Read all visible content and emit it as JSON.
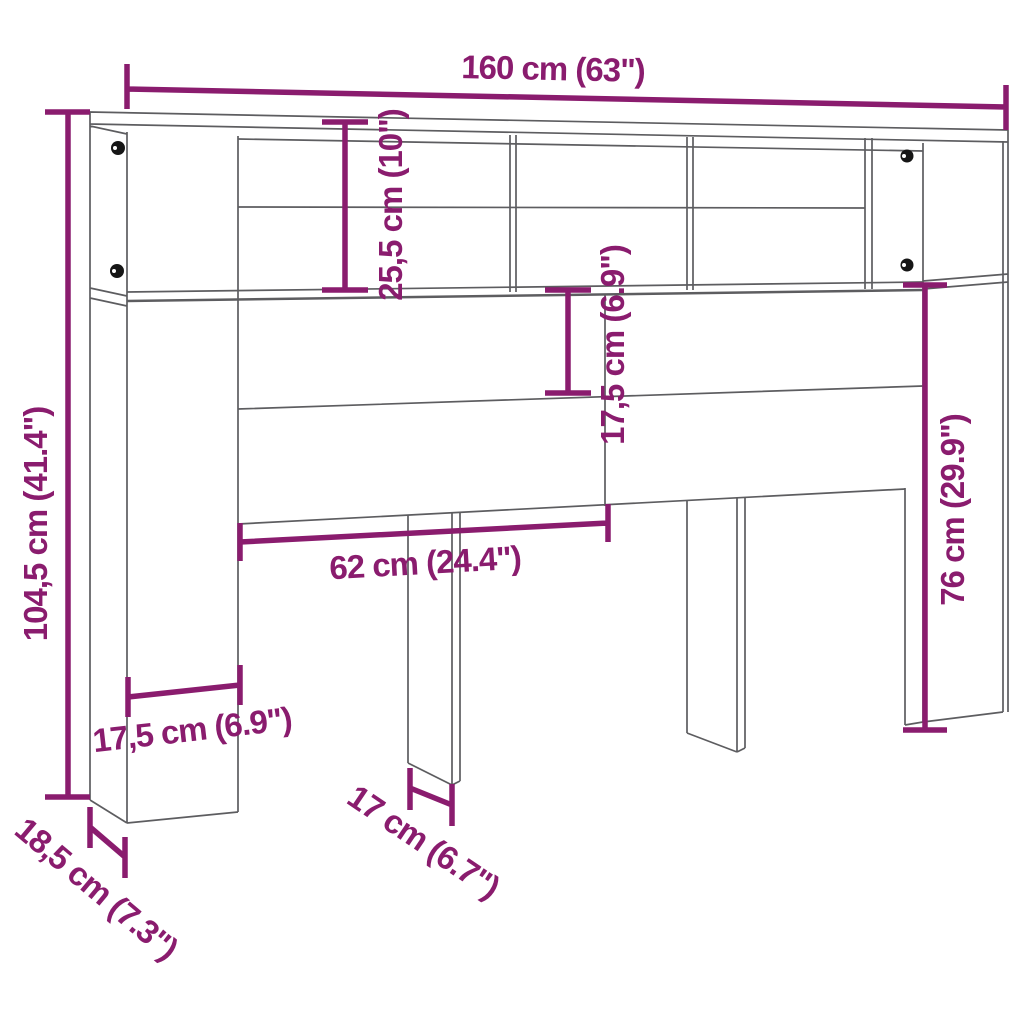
{
  "diagram": {
    "title": "headboard-cabinet-dimension-drawing",
    "colors": {
      "dimension": "#8a1c6e",
      "outline": "#5d5d60",
      "knob": "#161616",
      "background": "#ffffff"
    },
    "dimensions": {
      "total_width": "160 cm (63\")",
      "total_height": "104,5 cm (41.4\")",
      "top_compartment_height": "25,5 cm (10\")",
      "shelf_gap_height": "17,5 cm (6.9\")",
      "side_panel_height": "76 cm (29.9\")",
      "inner_width": "62 cm (24.4\")",
      "pillar_width": "17,5 cm (6.9\")",
      "depth": "18,5 cm (7.3\")",
      "leg_width": "17 cm (6.7\")"
    }
  }
}
